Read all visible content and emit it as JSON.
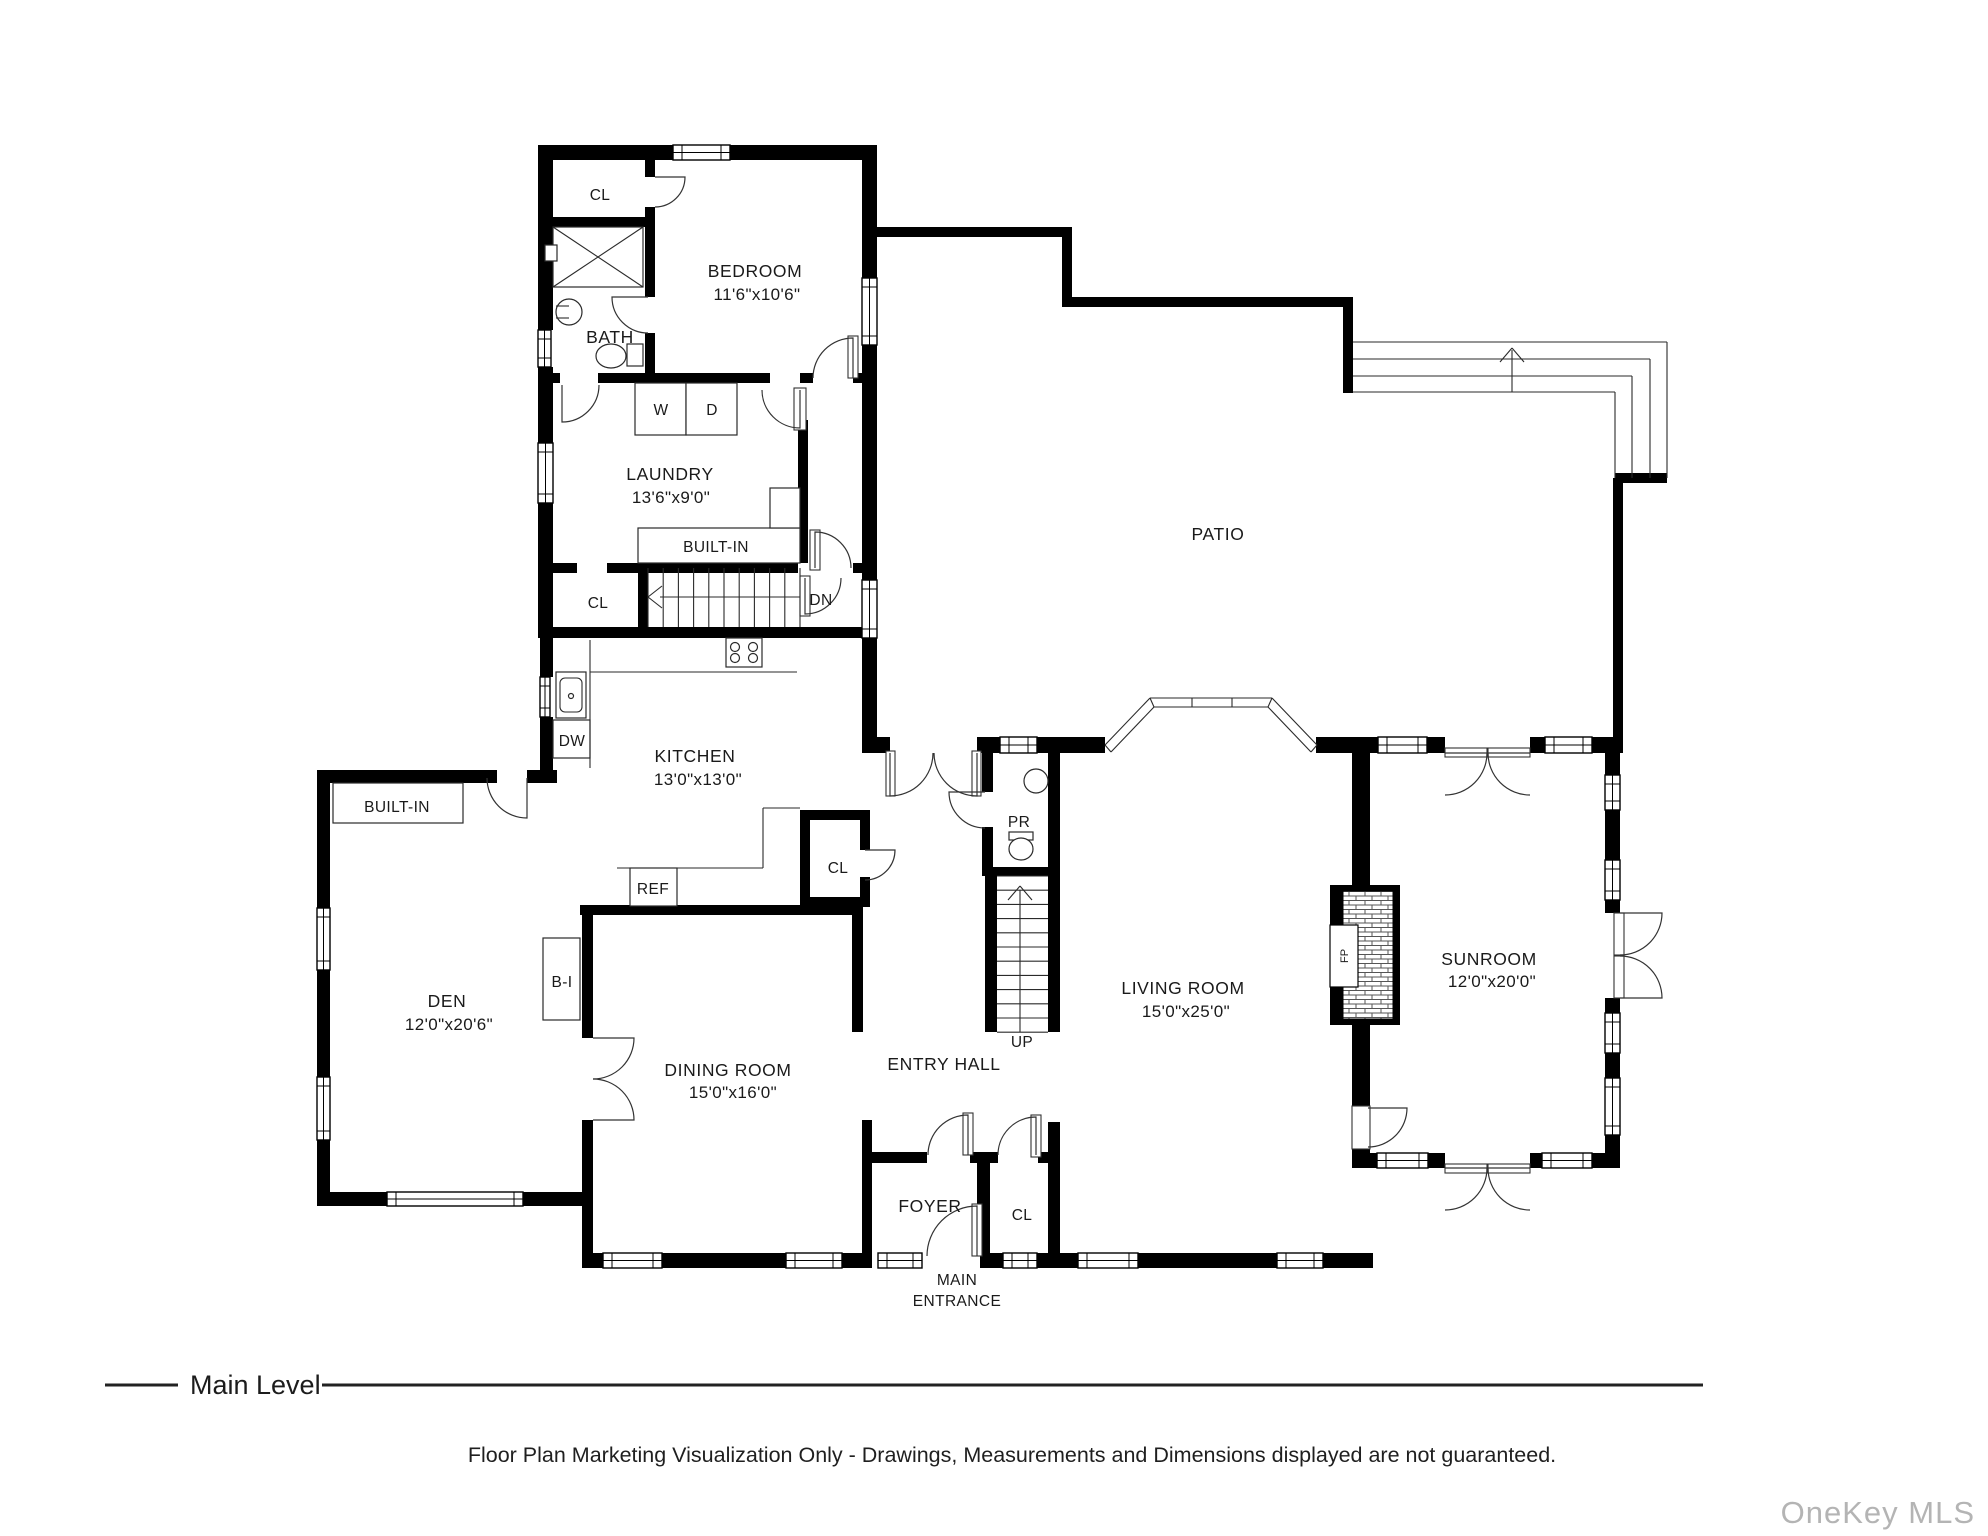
{
  "plan": {
    "rooms": {
      "bedroom": {
        "name": "BEDROOM",
        "dims": "11'6\"x10'6\""
      },
      "laundry": {
        "name": "LAUNDRY",
        "dims": "13'6\"x9'0\""
      },
      "kitchen": {
        "name": "KITCHEN",
        "dims": "13'0\"x13'0\""
      },
      "den": {
        "name": "DEN",
        "dims": "12'0\"x20'6\""
      },
      "dining": {
        "name": "DINING ROOM",
        "dims": "15'0\"x16'0\""
      },
      "living": {
        "name": "LIVING ROOM",
        "dims": "15'0\"x25'0\""
      },
      "sunroom": {
        "name": "SUNROOM",
        "dims": "12'0\"x20'0\""
      },
      "patio": "PATIO",
      "bath": "BATH",
      "entry_hall": "ENTRY HALL",
      "foyer": "FOYER",
      "main_entrance_line1": "MAIN",
      "main_entrance_line2": "ENTRANCE"
    },
    "fixtures": {
      "closet_bedroom": "CL",
      "closet_stairs": "CL",
      "closet_kitchen": "CL",
      "closet_foyer": "CL",
      "washer": "W",
      "dryer": "D",
      "dishwasher": "DW",
      "refrigerator": "REF",
      "built_in_laundry": "BUILT-IN",
      "built_in_den": "BUILT-IN",
      "built_in_small": "B-I",
      "powder_room": "PR",
      "stairs_down": "DN",
      "stairs_up": "UP",
      "fireplace": "FP"
    },
    "colors": {
      "wall": "#000000",
      "line": "#2a2a2a",
      "watermark": "#b4b4b4"
    }
  },
  "footer": {
    "level_label": "Main Level",
    "disclaimer": "Floor Plan Marketing Visualization Only - Drawings, Measurements and Dimensions displayed are not guaranteed.",
    "watermark": "OneKey MLS"
  }
}
